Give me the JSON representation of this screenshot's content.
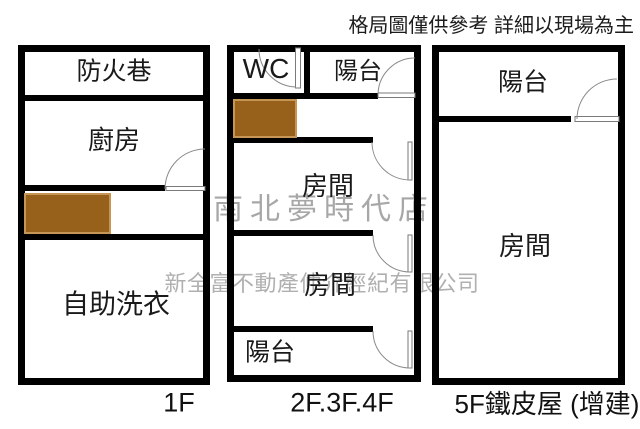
{
  "disclaimer": "格局圖僅供參考 詳細以現場為主",
  "watermarks": {
    "store_name": "南北夢時代店",
    "company_name": "新全富不動產仲介經紀有限公司"
  },
  "colors": {
    "background": "#ffffff",
    "wall": "#000000",
    "door_line": "#8a8a8a",
    "stairs_fill": "#97611b",
    "stairs_border": "#c59655",
    "label_text": "#1a1a1a",
    "watermark_gray": "#a7a7a7"
  },
  "floors": [
    {
      "label": "1F",
      "rooms": [
        {
          "name": "防火巷"
        },
        {
          "name": "廚房"
        },
        {
          "name": "自助洗衣"
        }
      ]
    },
    {
      "label": "2F.3F.4F",
      "rooms": [
        {
          "name": "WC"
        },
        {
          "name": "陽台"
        },
        {
          "name": "房間"
        },
        {
          "name": "房間"
        },
        {
          "name": "陽台"
        }
      ]
    },
    {
      "label": "5F鐵皮屋 (增建)",
      "rooms": [
        {
          "name": "陽台"
        },
        {
          "name": "房間"
        }
      ]
    }
  ]
}
